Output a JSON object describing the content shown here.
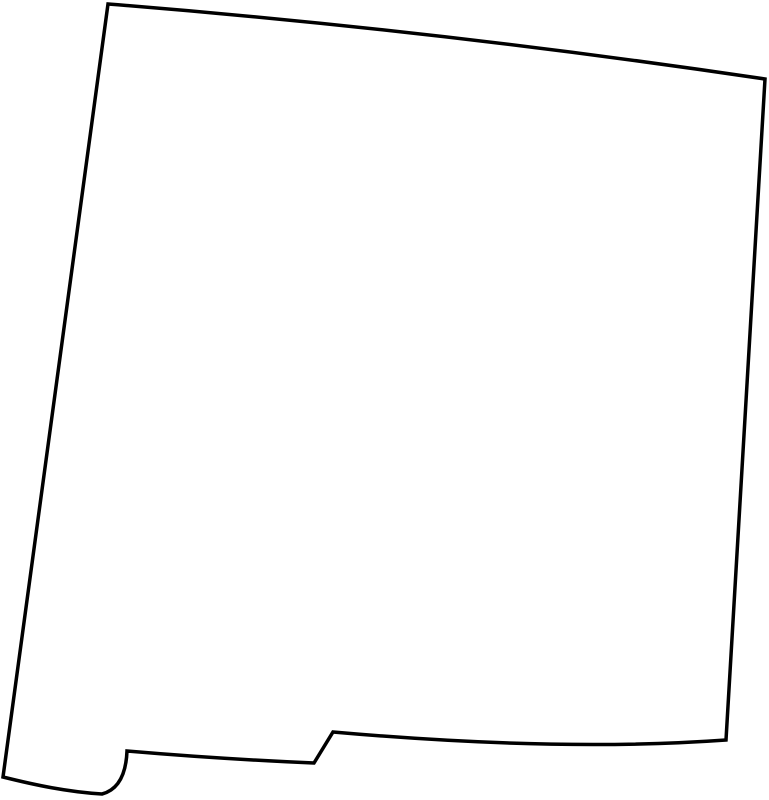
{
  "map": {
    "region": "New Mexico",
    "map_type": "blank state outline map",
    "outline_path": "M 108,4 Q 435,30 765,79 L 726,740 Q 560,752 333,732 L 314,763 Q 220,759 127,751 C 126,776 117,790 102,794 C 68,792 35,785 3,777 Z",
    "stroke_width": "3.5"
  },
  "colors": {
    "state_stroke": "#000000",
    "state_fill": "#ffffff",
    "background": "#ffffff"
  }
}
